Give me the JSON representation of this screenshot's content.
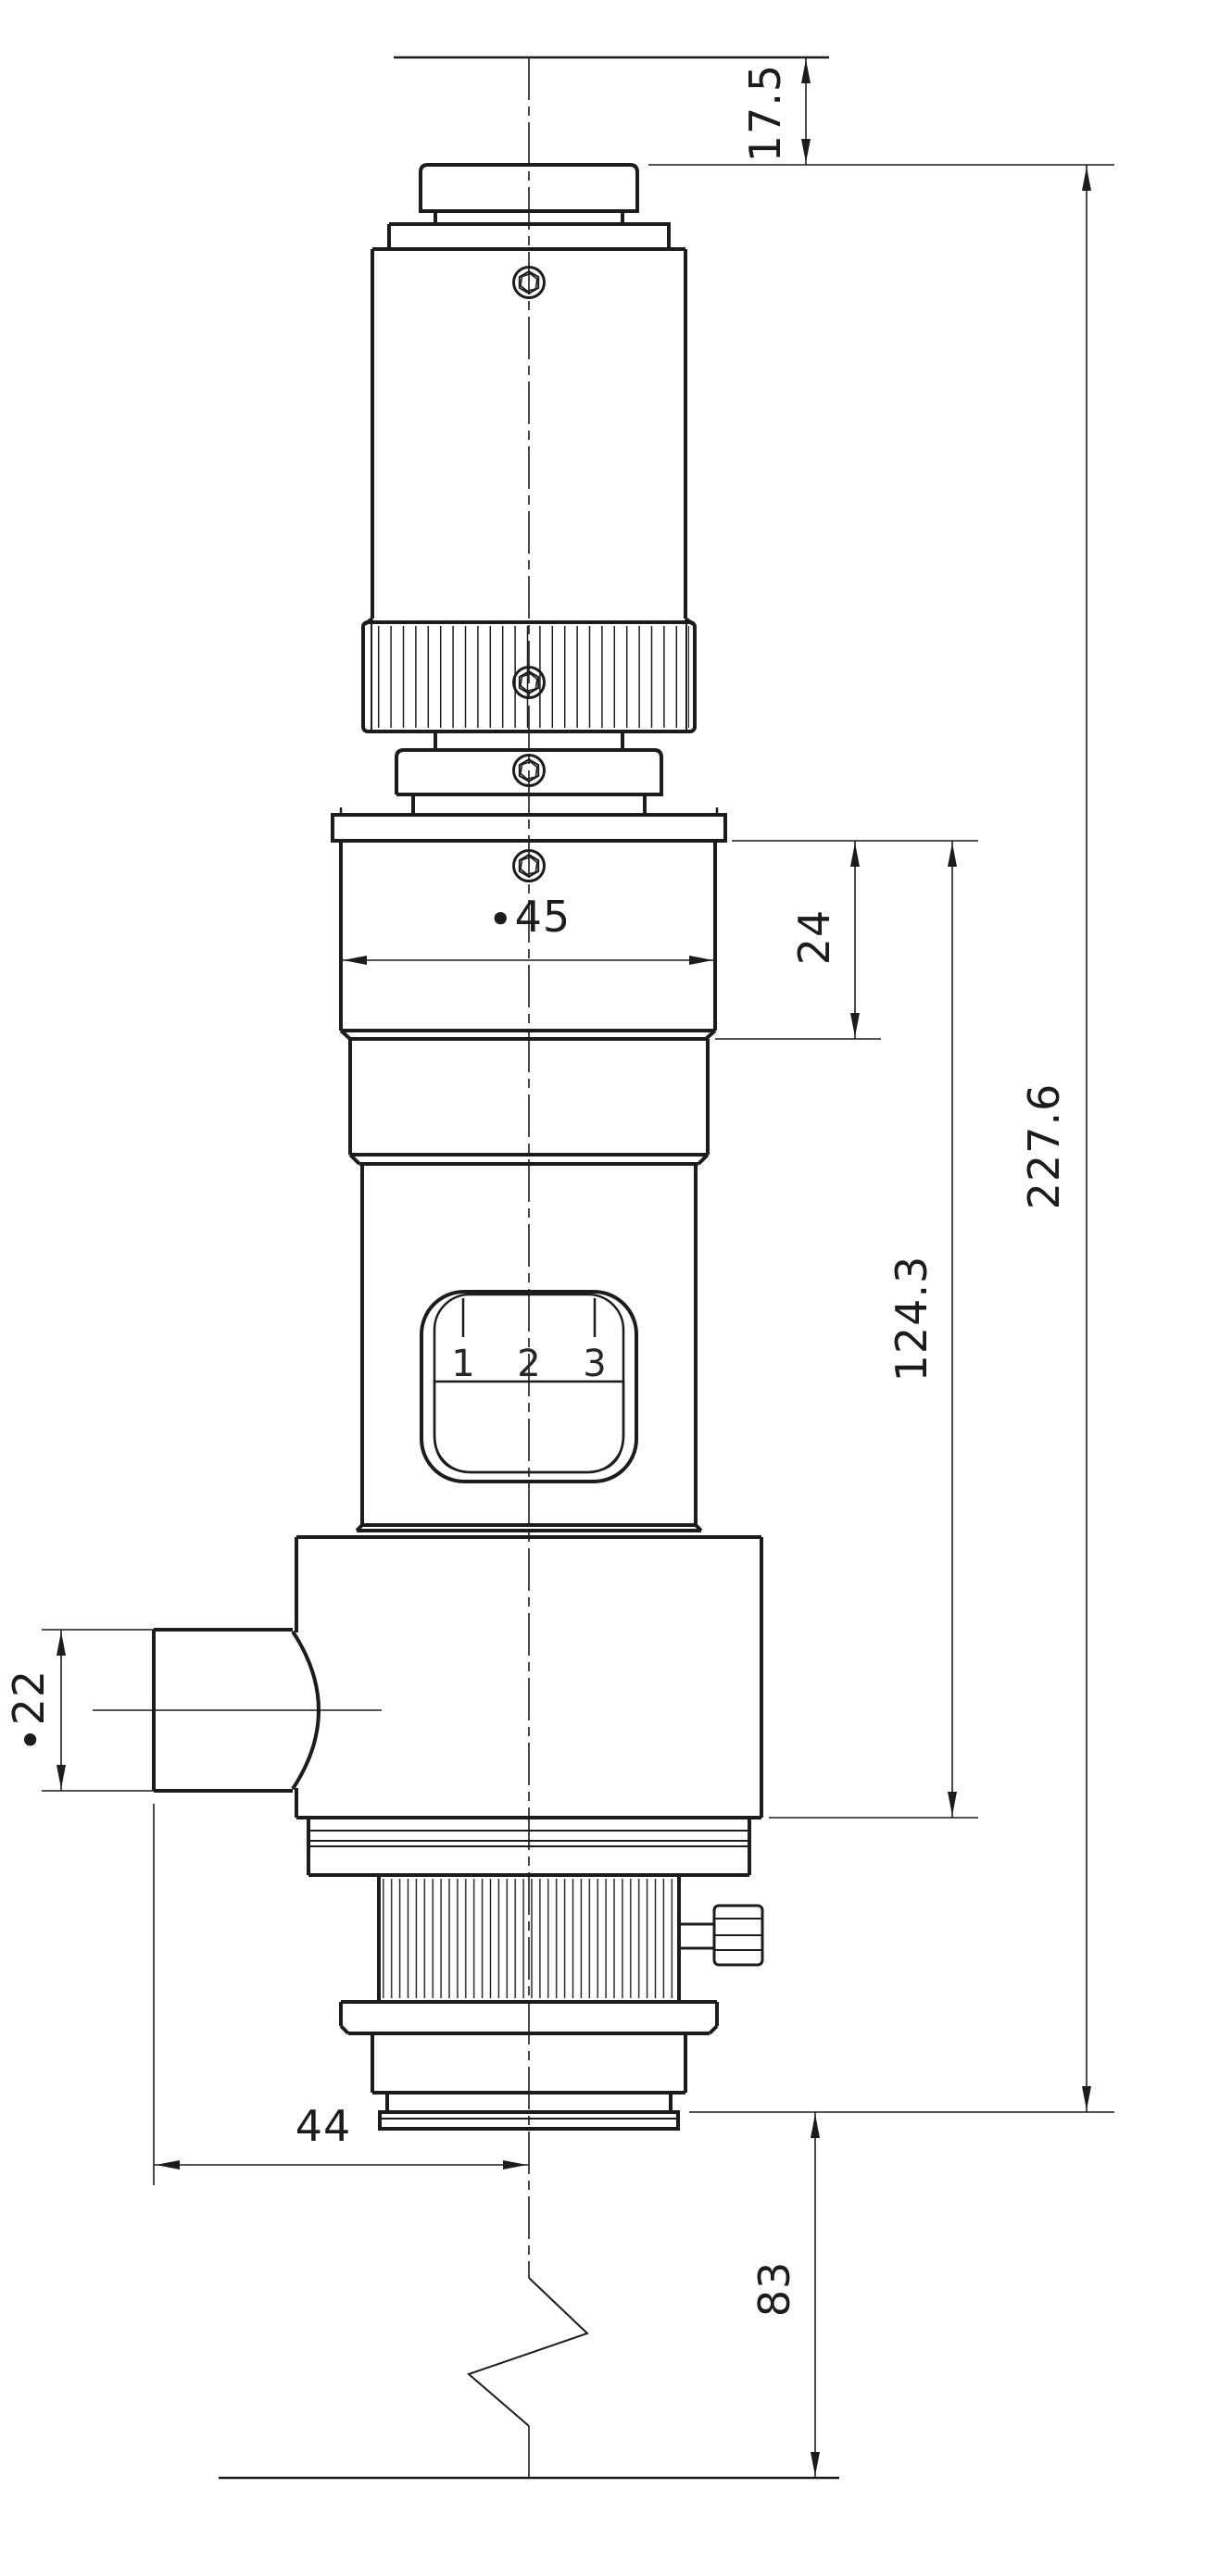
{
  "drawing": {
    "background": "#ffffff",
    "line_color": "#1c1c1c",
    "dimensions": {
      "top_offset": "17.5",
      "overall_length": "227.6",
      "upper_body_height": "24",
      "lower_body_length": "124.3",
      "body_diameter": "∙45",
      "side_port_diameter": "∙22",
      "side_port_offset": "44",
      "bottom_offset": "83"
    },
    "selector_ticks": [
      "1",
      "2",
      "3"
    ]
  }
}
